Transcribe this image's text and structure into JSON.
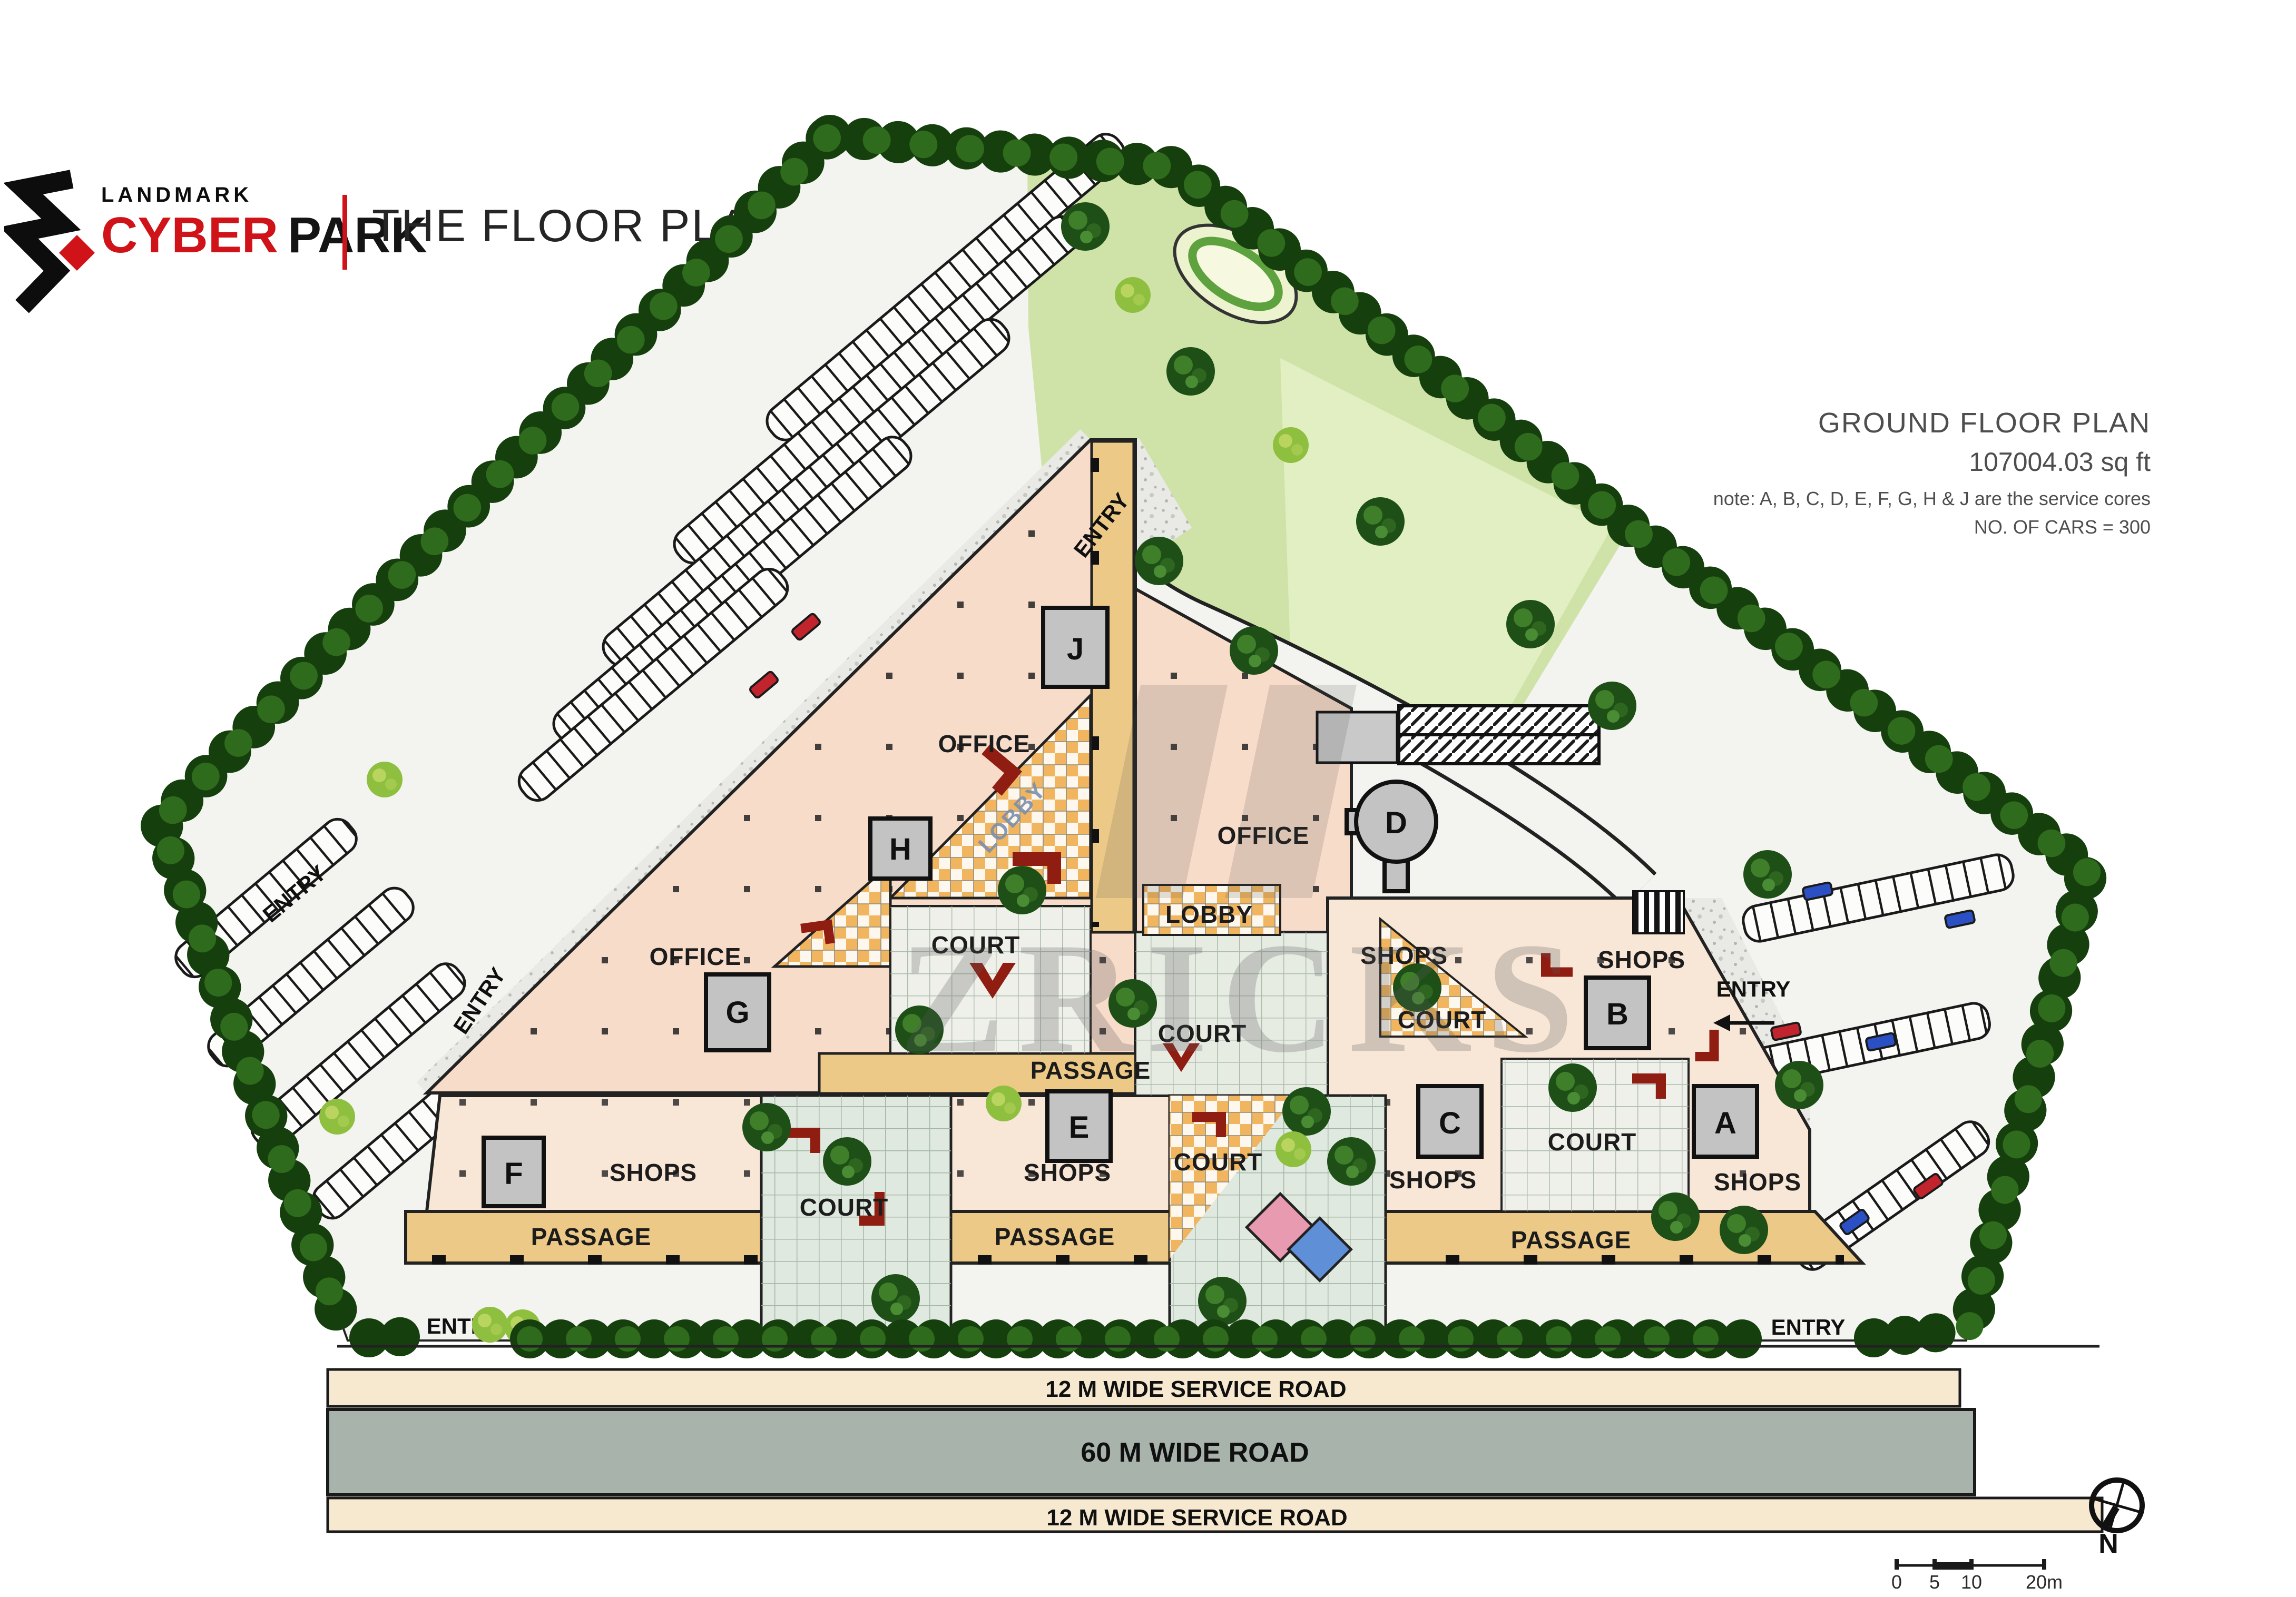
{
  "header": {
    "brand_line1": "LANDMARK",
    "brand_word_red": "CYBER",
    "brand_word_dark": "PARK",
    "title": "THE FLOOR PLANS"
  },
  "info": {
    "line1": "GROUND FLOOR PLAN",
    "line2": "107004.03 sq ft",
    "line3": "note: A, B, C, D, E, F, G, H & J are the service cores",
    "line4": "NO. OF CARS = 300"
  },
  "plan": {
    "watermark": "ZRICKS",
    "compass": "N",
    "labels": {
      "office": "OFFICE",
      "shops": "SHOPS",
      "court": "COURT",
      "passage": "PASSAGE",
      "lobby": "LOBBY",
      "entry": "ENTRY"
    },
    "cores": [
      "A",
      "B",
      "C",
      "D",
      "E",
      "F",
      "G",
      "H",
      "J"
    ],
    "roads": {
      "service_top": "12 M WIDE SERVICE ROAD",
      "main": "60 M WIDE ROAD",
      "service_bottom": "12 M WIDE SERVICE ROAD"
    },
    "scale": {
      "t0": "0",
      "t1": "5",
      "t2": "10",
      "t3": "20m"
    },
    "colors": {
      "office_fill": "#f8dcca",
      "shops_fill": "#f8e6d6",
      "passage_fill": "#ecc987",
      "court_green": "#dfe9df",
      "core_gray": "#c3c3c3",
      "road_main": "#a7b3ab",
      "road_service": "#f7e9d0",
      "hedge_green": "#1a4a10",
      "accent_red": "#d01318"
    }
  }
}
